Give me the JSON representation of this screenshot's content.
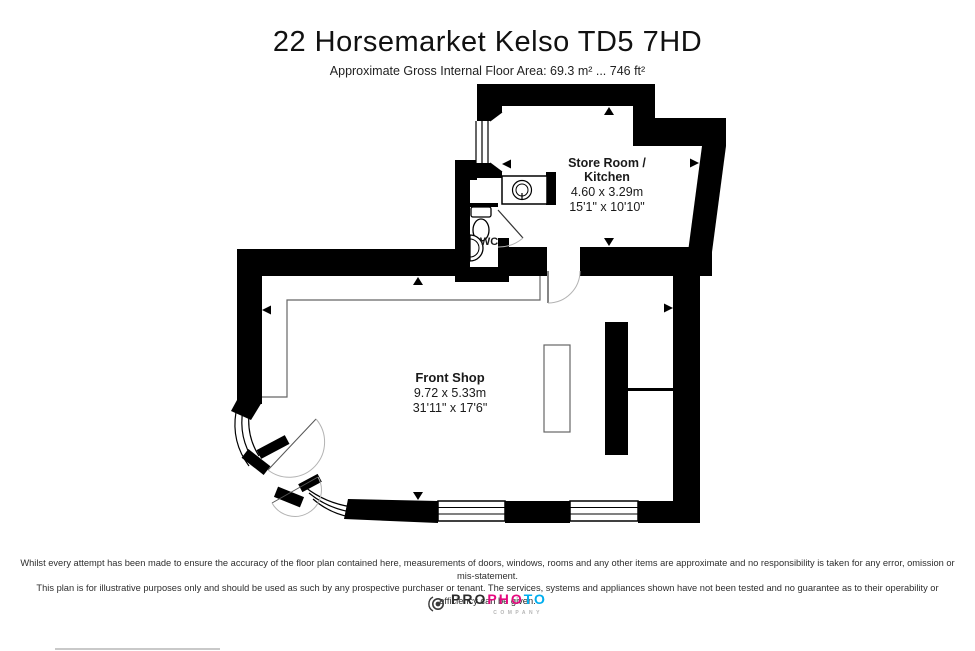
{
  "page": {
    "title": "22 Horsemarket Kelso TD5 7HD",
    "subtitle": "Approximate Gross Internal Floor Area: 69.3 m² ... 746 ft²"
  },
  "plan": {
    "wall_color": "#000000",
    "rooms": {
      "store_room": {
        "name_line1": "Store Room /",
        "name_line2": "Kitchen",
        "dims_metric": "4.60 x 3.29m",
        "dims_imperial": "15'1\" x 10'10\""
      },
      "wc": {
        "name": "WC"
      },
      "front_shop": {
        "name": "Front Shop",
        "dims_metric": "9.72 x 5.33m",
        "dims_imperial": "31'11\" x 17'6\""
      }
    }
  },
  "footer": {
    "disclaimer_line1": "Whilst every attempt has been made to ensure the accuracy of the floor plan contained here, measurements of doors, windows, rooms and any other items are approximate and no responsibility is taken for any error, omission or mis-statement.",
    "disclaimer_line2": "This plan is for illustrative purposes only and should be used as such by any prospective purchaser or tenant. The services, systems and appliances shown have not been tested and no guarantee as to their operability or efficiency can be given."
  },
  "logo": {
    "brand_black": "PRO",
    "brand_pink": "PHO",
    "brand_cyan": "TO",
    "sub": "COMPANY",
    "pink": "#e5097f",
    "cyan": "#00aeef"
  }
}
